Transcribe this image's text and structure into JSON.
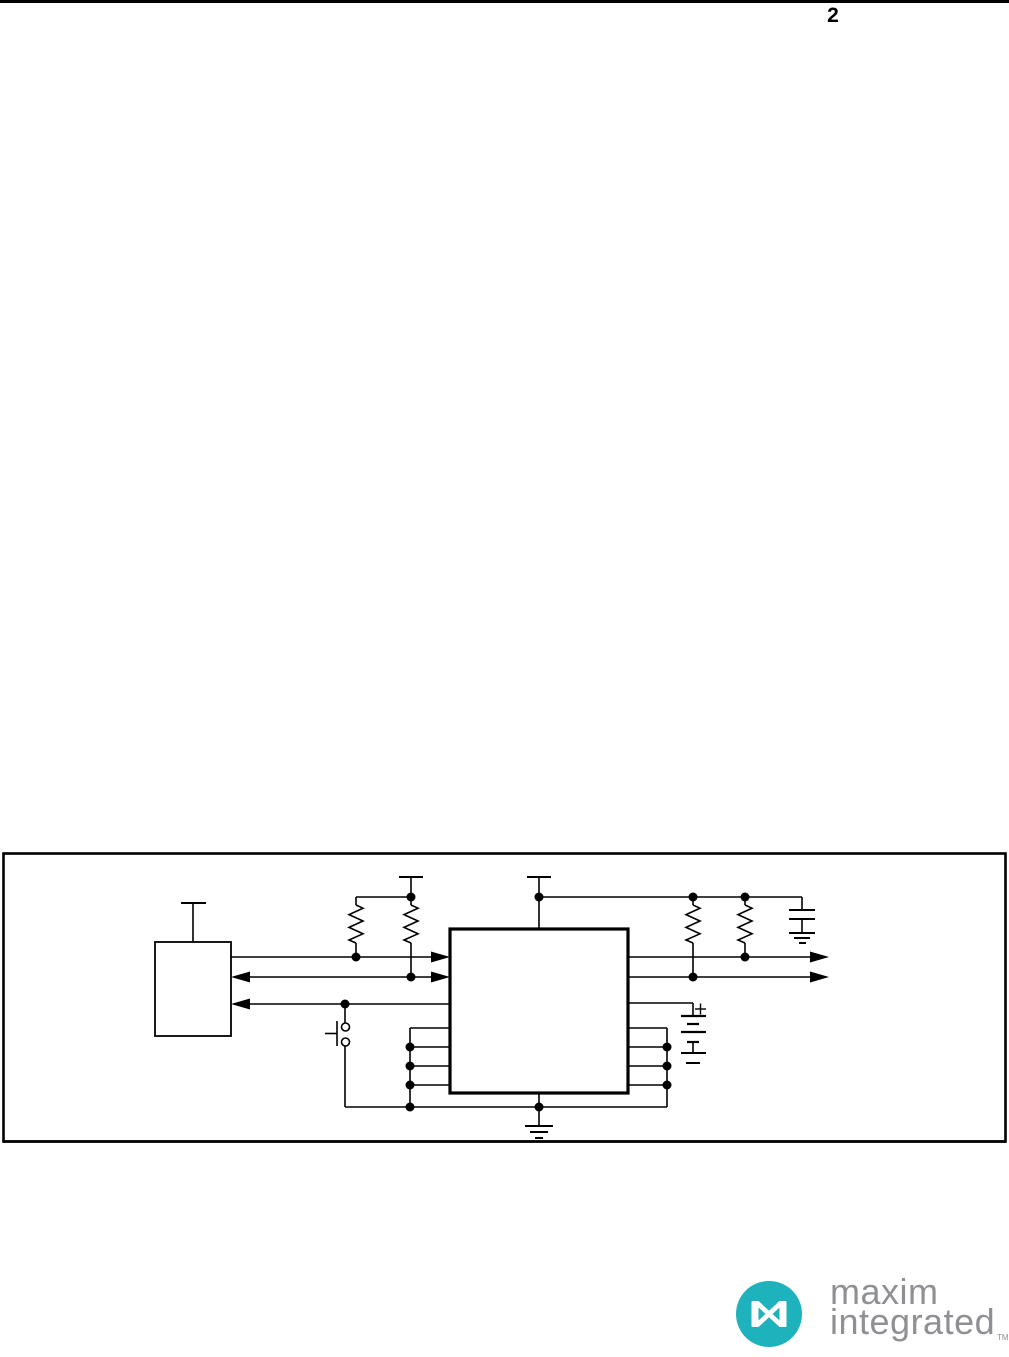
{
  "page": {
    "number": "2",
    "background_color": "#ffffff",
    "ink_color": "#000000"
  },
  "figure": {
    "kind": "circuit-diagram",
    "components": [
      "host-device-box",
      "power-tee-icon",
      "pullup-resistor-icon",
      "pullup-resistor-icon",
      "main-ic-box",
      "power-tee-icon",
      "pullup-resistor-icon",
      "pullup-resistor-icon",
      "capacitor-to-ground-icon",
      "battery-to-ground-icon",
      "push-button-icon",
      "ground-icon",
      "signal-arrow-icon",
      "signal-arrow-icon",
      "signal-arrow-icon"
    ]
  },
  "logo": {
    "line1": "maxim",
    "line2": "integrated",
    "trademark": "TM",
    "teal_color": "#1eb2bc",
    "text_color": "#8e9094"
  }
}
